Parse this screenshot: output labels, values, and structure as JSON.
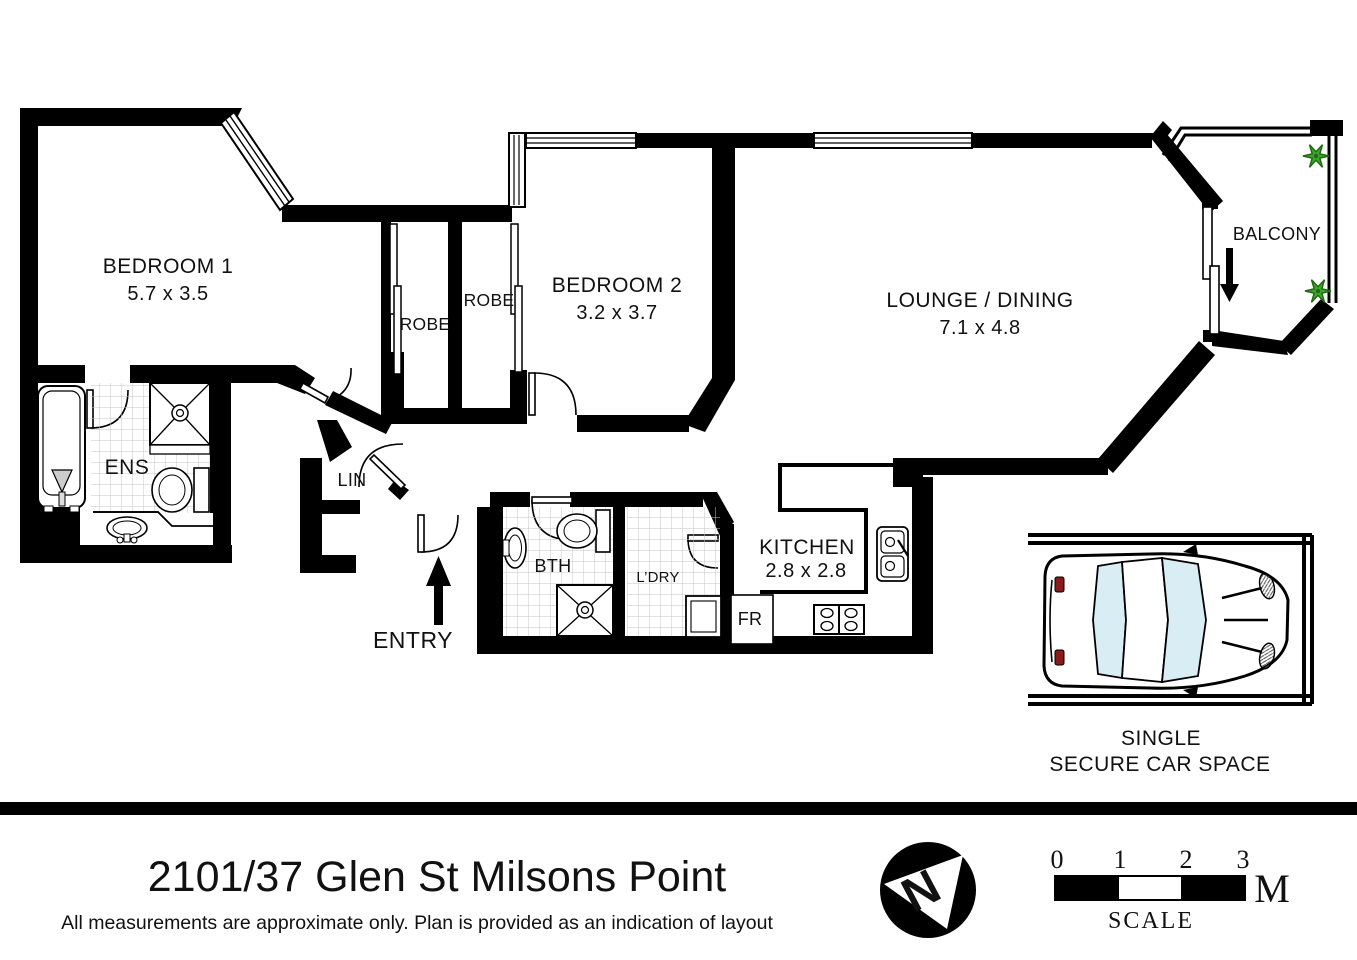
{
  "meta": {
    "title": "2101/37 Glen St Milsons Point",
    "disclaimer": "All measurements are approximate only. Plan is provided as an indication of layout"
  },
  "rooms": {
    "bedroom1": {
      "label": "BEDROOM 1",
      "dims": "5.7 x 3.5"
    },
    "bedroom2": {
      "label": "BEDROOM 2",
      "dims": "3.2 x 3.7"
    },
    "lounge": {
      "label": "LOUNGE / DINING",
      "dims": "7.1 x 4.8"
    },
    "kitchen": {
      "label": "KITCHEN",
      "dims": "2.8 x 2.8"
    },
    "balcony": {
      "label": "BALCONY"
    },
    "ensuite": {
      "label": "ENS"
    },
    "bathroom": {
      "label": "BTH"
    },
    "laundry": {
      "label": "L’DRY"
    },
    "linen": {
      "label": "LIN"
    },
    "robe1": {
      "label": "ROBE"
    },
    "robe2": {
      "label": "ROBE"
    },
    "fridge": {
      "label": "FR"
    },
    "entry": {
      "label": "ENTRY"
    }
  },
  "car_space": {
    "line1": "SINGLE",
    "line2": "SECURE CAR SPACE"
  },
  "compass": {
    "label": "N"
  },
  "scale_bar": {
    "ticks": [
      "0",
      "1",
      "2",
      "3"
    ],
    "unit": "M",
    "label": "SCALE"
  },
  "colors": {
    "wall": "#000000",
    "plant_green": "#3fa52c",
    "plant_green_dark": "#1e6b12",
    "glass_blue": "#d9edf4",
    "tail_light_red": "#8b1a1a",
    "tile_line": "#c4c4c4"
  }
}
